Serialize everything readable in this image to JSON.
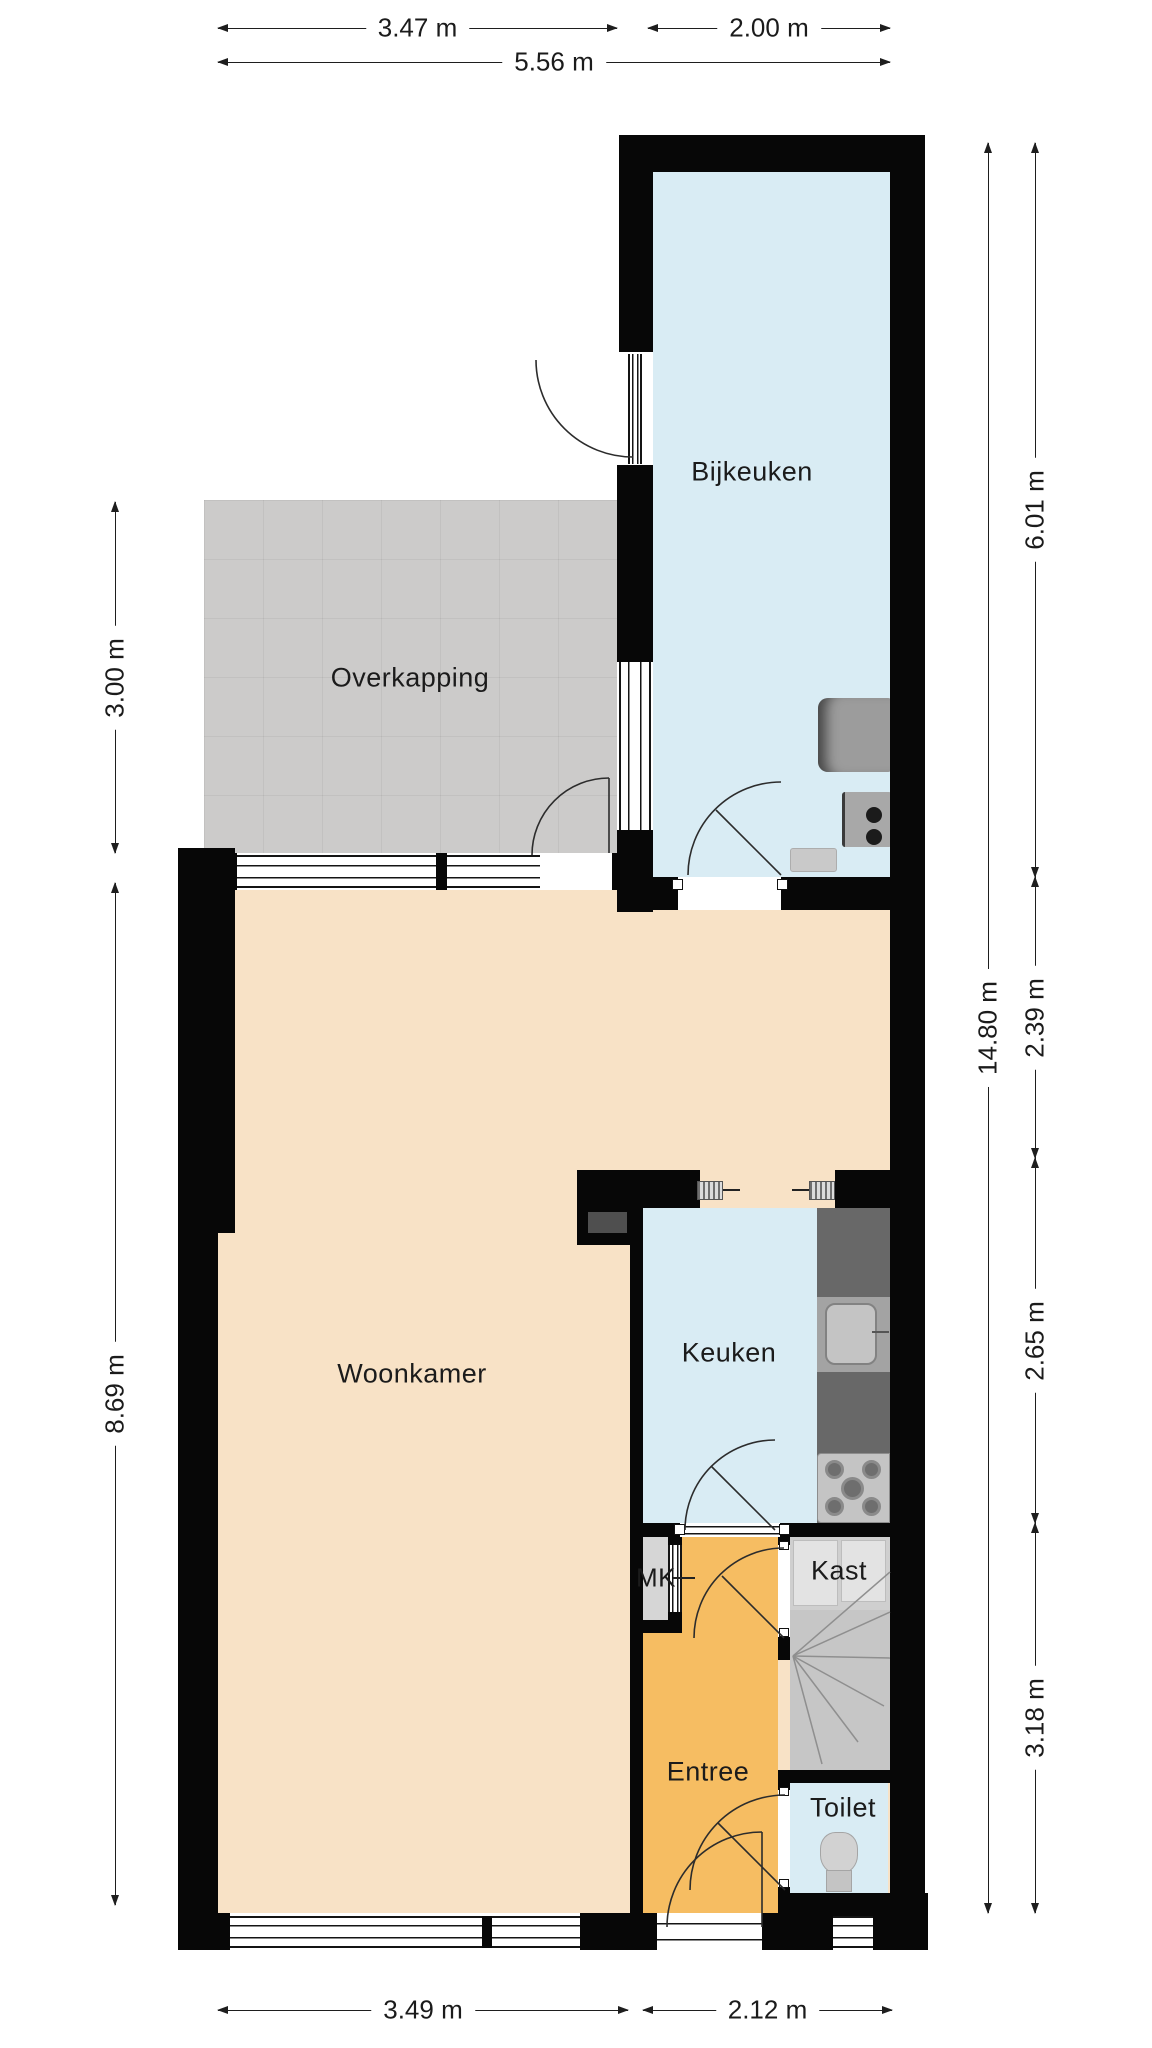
{
  "plan_title": "Begane grond plattegrond",
  "rooms": {
    "bijkeuken": "Bijkeuken",
    "overkapping": "Overkapping",
    "woonkamer": "Woonkamer",
    "keuken": "Keuken",
    "entree": "Entree",
    "toilet": "Toilet",
    "kast": "Kast",
    "mk": "MK"
  },
  "dimensions": {
    "top_left": "3.47 m",
    "top_right": "2.00 m",
    "top_total": "5.56 m",
    "left_upper": "3.00 m",
    "left_lower": "8.69 m",
    "right_bijkeuken": "6.01 m",
    "right_dining": "2.39 m",
    "right_keuken": "2.65 m",
    "right_entree": "3.18 m",
    "right_total": "14.80 m",
    "bottom_left": "3.49 m",
    "bottom_right": "2.12 m"
  },
  "colors": {
    "wall": "#070707",
    "floor_living": "#f8e2c6",
    "floor_wet": "#d9ecf4",
    "floor_entry": "#f6bd62",
    "floor_outdoor": "#cccbca",
    "floor_closet": "#cfcfcf",
    "floor_stairs": "#c6c6c6",
    "counter": "#686868",
    "dimension_line": "#1e1e1e"
  }
}
